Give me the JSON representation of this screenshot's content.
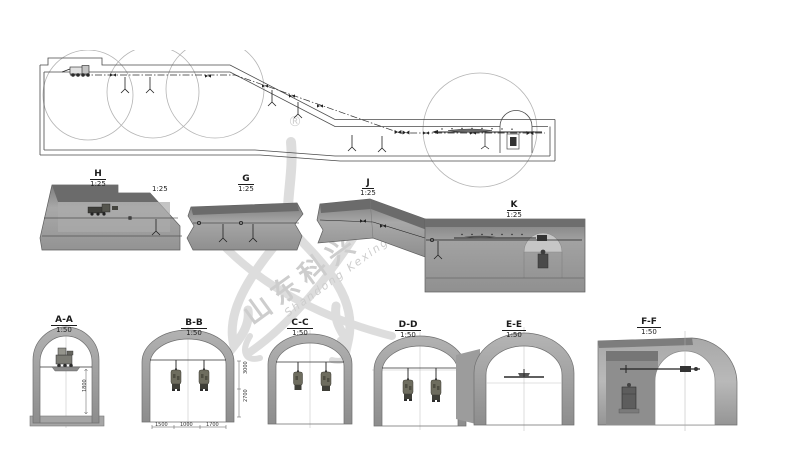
{
  "watermark": {
    "registered": "®",
    "cn": "山东科兴",
    "en": "Shandong Kexing"
  },
  "detail_sections": [
    {
      "name": "H",
      "scale": "1:25"
    },
    {
      "name": "",
      "scale": "1:25"
    },
    {
      "name": "G",
      "scale": "1:25"
    },
    {
      "name": "J",
      "scale": "1:25"
    },
    {
      "name": "K",
      "scale": "1:25"
    }
  ],
  "cross_sections": [
    {
      "name": "A-A",
      "scale": "1:50",
      "dims": {
        "vertical": [
          "1800"
        ],
        "horizontal": []
      }
    },
    {
      "name": "B-B",
      "scale": "1:50",
      "dims": {
        "vertical": [
          "3000",
          "2700"
        ],
        "horizontal": [
          "1500",
          "1000",
          "1700"
        ]
      }
    },
    {
      "name": "C-C",
      "scale": "1:50"
    },
    {
      "name": "D-D",
      "scale": "1:50"
    },
    {
      "name": "E-E",
      "scale": "1:50"
    },
    {
      "name": "F-F",
      "scale": "1:50"
    }
  ],
  "colors": {
    "background": "#ffffff",
    "line": "#3a3a3a",
    "solid_gray": "#9a9a9a",
    "watermark": "#d6d6d6"
  }
}
